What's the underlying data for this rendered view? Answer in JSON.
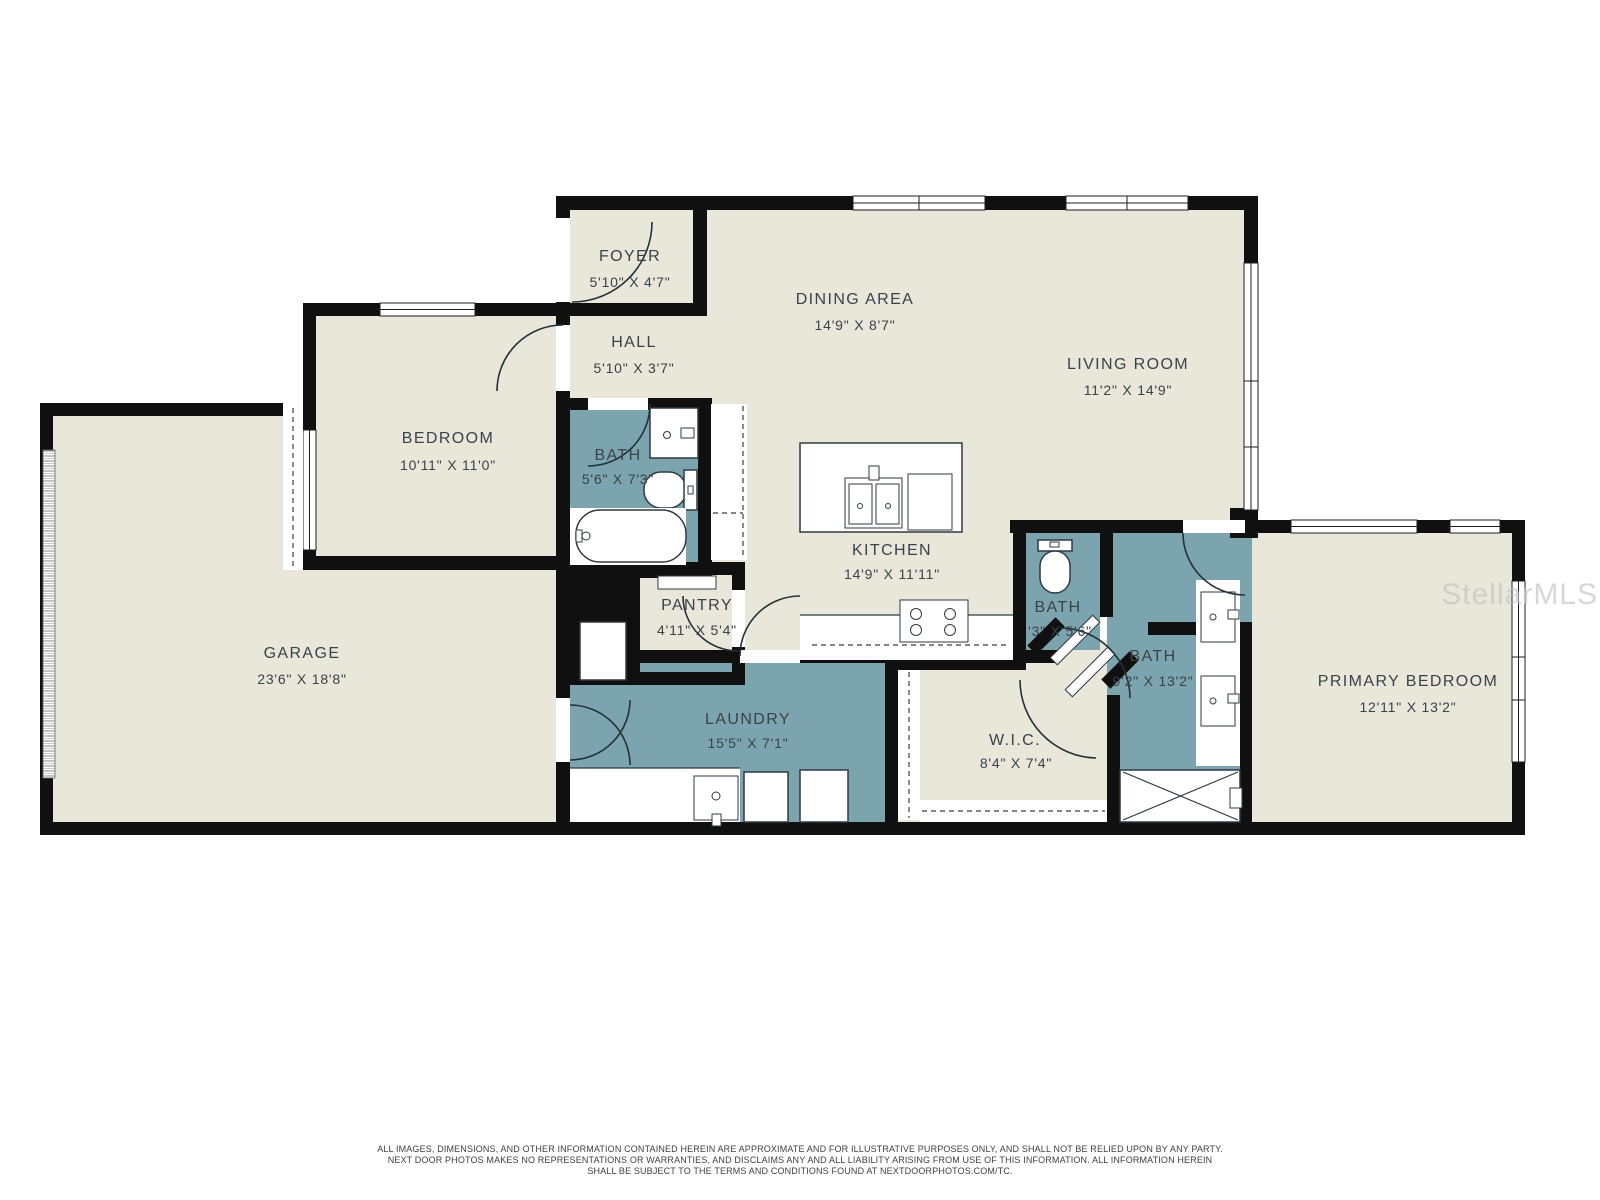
{
  "watermark": "StellarMLS",
  "colors": {
    "floor_beige": "#e9e6da",
    "room_teal": "#7ca4ae",
    "wall_black": "#101010",
    "line_dark": "#24313a",
    "label_gray": "#3a424a",
    "watermark_gray": "#c2c2c2"
  },
  "rooms": [
    {
      "id": "foyer",
      "name": "FOYER",
      "dims": "5'10\" X 4'7\""
    },
    {
      "id": "dining",
      "name": "DINING AREA",
      "dims": "14'9\" X 8'7\""
    },
    {
      "id": "living",
      "name": "LIVING ROOM",
      "dims": "11'2\" X 14'9\""
    },
    {
      "id": "hall",
      "name": "HALL",
      "dims": "5'10\" X 3'7\""
    },
    {
      "id": "bedroom",
      "name": "BEDROOM",
      "dims": "10'11\" X 11'0\""
    },
    {
      "id": "bath1",
      "name": "BATH",
      "dims": "5'6\" X 7'3\""
    },
    {
      "id": "garage",
      "name": "GARAGE",
      "dims": "23'6\" X 18'8\""
    },
    {
      "id": "kitchen",
      "name": "KITCHEN",
      "dims": "14'9\" X 11'11\""
    },
    {
      "id": "pantry",
      "name": "PANTRY",
      "dims": "4'11\" X 5'4\""
    },
    {
      "id": "laundry",
      "name": "LAUNDRY",
      "dims": "15'5\" X 7'1\""
    },
    {
      "id": "wic",
      "name": "W.I.C.",
      "dims": "8'4\" X 7'4\""
    },
    {
      "id": "bath2",
      "name": "BATH",
      "dims": "'3\" X 5'6\""
    },
    {
      "id": "bath3",
      "name": "BATH",
      "dims": "9'2\" X 13'2\""
    },
    {
      "id": "primary",
      "name": "PRIMARY BEDROOM",
      "dims": "12'11\" X 13'2\""
    }
  ],
  "disclaimer": {
    "line1": "ALL IMAGES, DIMENSIONS, AND OTHER INFORMATION CONTAINED HEREIN ARE APPROXIMATE AND FOR ILLUSTRATIVE PURPOSES ONLY, AND SHALL NOT BE RELIED UPON BY ANY PARTY.",
    "line2": "NEXT DOOR PHOTOS MAKES NO REPRESENTATIONS OR WARRANTIES, AND DISCLAIMS ANY AND ALL LIABILITY ARISING FROM USE OF THIS INFORMATION. ALL INFORMATION HEREIN",
    "line3": "SHALL BE SUBJECT TO THE TERMS AND CONDITIONS FOUND AT NEXTDOORPHOTOS.COM/TC."
  }
}
